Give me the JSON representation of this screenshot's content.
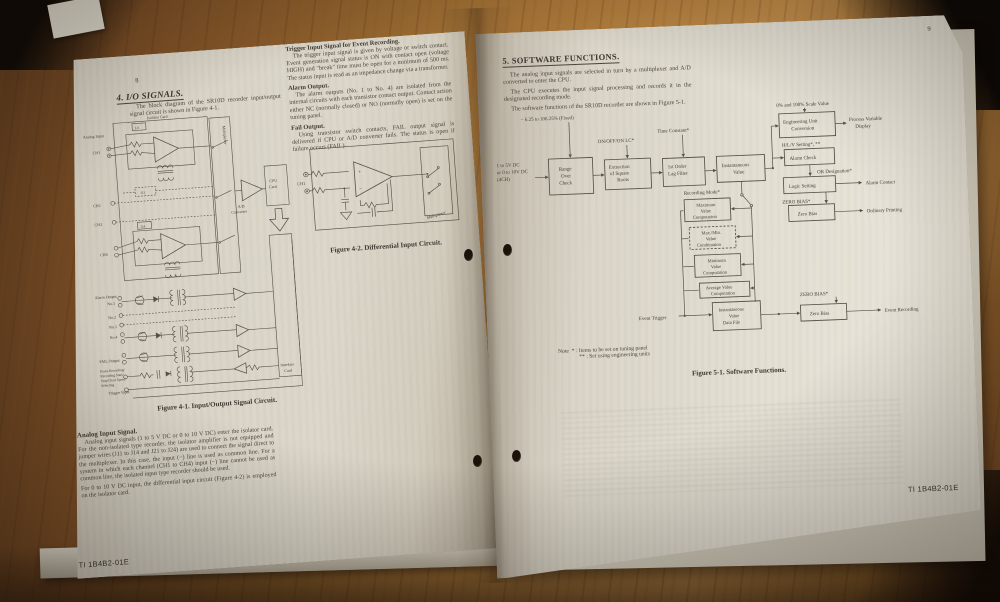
{
  "colors": {
    "wood": "#a9763a",
    "paper": "#ddd8cb",
    "ink": "#45403a"
  },
  "doc_code": "TI 1B4B2-01E",
  "left_page": {
    "page_number": "8",
    "section_heading": "4. I/O SIGNALS.",
    "intro": "The block diagram of the SR10D recorder input/output signal circuit is shown in Figure 4-1.",
    "trigger_section": {
      "heading": "Trigger Input Signal for Event Recording.",
      "body": "The trigger input signal is given by voltage or switch contact. Event generation signal status is ON with contact open (voltage HIGH) and \"break\" time must be open for a minimum of 500 ms. The status input is read as an impedance change via a transformer."
    },
    "alarm_section": {
      "heading": "Alarm Output.",
      "body": "The alarm outputs (No. 1 to No. 4) are isolated from the internal circuits with each transistor contact output. Contact action either NC (normally closed) or NO (normally open) is set on the tuning panel."
    },
    "fail_section": {
      "heading": "Fail Output.",
      "body": "Using transistor switch contacts, FAIL output signal is delivered if CPU or A/D converter fails. The status is open if failure occurs (FAIL)."
    },
    "fig41": {
      "caption": "Figure 4-1.  Input/Output Signal Circuit.",
      "labels": {
        "analog_input": "Analog Input",
        "ch1": "CH1",
        "ch2": "CH2",
        "ch3": "CH3",
        "ch4": "CH4",
        "j21": "J21",
        "j11": "J11",
        "j24": "J24",
        "isolator_card": "Isolator Card",
        "multiplexer": "Multiplexer",
        "ad1": "A/D",
        "ad2": "Converter",
        "cpu1": "CPU",
        "cpu2": "Card",
        "if1": "Interface",
        "if2": "Card",
        "alarm_output": "Alarm Output",
        "no1": "No.1",
        "no2": "No.2",
        "no3": "No.3",
        "no4": "No.4",
        "fail_output": "FAIL Output",
        "event1": "Event Recording/",
        "event2": "Recording Start/",
        "event3": "Stop/Chart Speed",
        "event4": "Selecting",
        "trigger_input": "Trigger Input"
      }
    },
    "fig42": {
      "caption": "Figure 4-2.  Differential Input Circuit.",
      "labels": {
        "ch1": "CH1",
        "plus": "+",
        "minus": "−",
        "multiplexer": "Multiplexer"
      }
    },
    "analog_section": {
      "heading": "Analog Input Signal.",
      "body1": "Analog input signals (1 to 5 V DC or 0 to 10 V DC) enter the isolator card. For the non-isolated type recorder, the isolator amplifier is not equipped and jumper wires (J11 to J14 and J21 to J24) are used to connect the signal direct to the multiplexer. In this case, the input (−) line is used as common line. For a system in which each channel (CH1 to CH4) input (−) line cannot be used as common line, the isolated input type recorder should be used.",
      "body2": "For 0 to 10 V DC input, the differential input circuit (Figure 4-2) is employed on the isolator card."
    }
  },
  "right_page": {
    "page_number": "9",
    "section_heading": "5. SOFTWARE FUNCTIONS.",
    "para1": "The analog input signals are selected in turn by a multiplexer and A/D converted to enter the CPU.",
    "para2": "The CPU executes the input signal processing and records it in the designated recording mode.",
    "para3": "The software functions of the SR10D recorder are shown in Figure 5-1.",
    "fig51": {
      "caption": "Figure 5-1.  Software Functions.",
      "input": [
        "1 to 5V DC",
        "or 0 to 10V DC",
        "(4CH)"
      ],
      "ann_fixed": "− 6.25 to 106.25% (Fixed)",
      "ann_onoff": "ON/OFF/ON LC*",
      "ann_time": "Time Constant*",
      "box_range": [
        "Range",
        "Over",
        "Check"
      ],
      "box_extraction": [
        "Extraction",
        "of Square",
        "Roots"
      ],
      "box_lag": [
        "1st Order",
        "Lag Filter"
      ],
      "box_inst": [
        "Instantaneous",
        "Value"
      ],
      "lbl_scale": "0% and 100% Scale Value",
      "box_eng": [
        "Engineering Unit",
        "Conversion"
      ],
      "out_pvd": [
        "Process Variable",
        "Display"
      ],
      "lbl_hlv": "H/L/V Setting*, **",
      "box_alarm": "Alarm Check",
      "lbl_or": "OR Designation*",
      "box_logic": "Logic Setting",
      "out_alarm": "Alarm Contact",
      "lbl_zero1": "ZERO BIAS*",
      "box_zero1": "Zero Bias",
      "out_ordinary": "Ordinary Printing",
      "lbl_recmode": "Recording Mode*",
      "box_max": [
        "Maximum",
        "Value",
        "Computation"
      ],
      "box_maxmin": [
        "Max./Min.",
        "Value",
        "Combination"
      ],
      "box_min": [
        "Minimum",
        "Value",
        "Computation"
      ],
      "box_avg": [
        "Average Value",
        "Computation"
      ],
      "lbl_event_trigger": "Event Trigger",
      "box_datafile": [
        "Instantaneous",
        "Value",
        "Data File"
      ],
      "lbl_zero2": "ZERO BIAS*",
      "box_zero2": "Zero Bias",
      "out_event": "Event Recording",
      "note_label": "Note",
      "note1_sym": "* :",
      "note1": "Items to be set on tuning panel",
      "note2_sym": "** :",
      "note2": "Set using engineering units"
    }
  }
}
